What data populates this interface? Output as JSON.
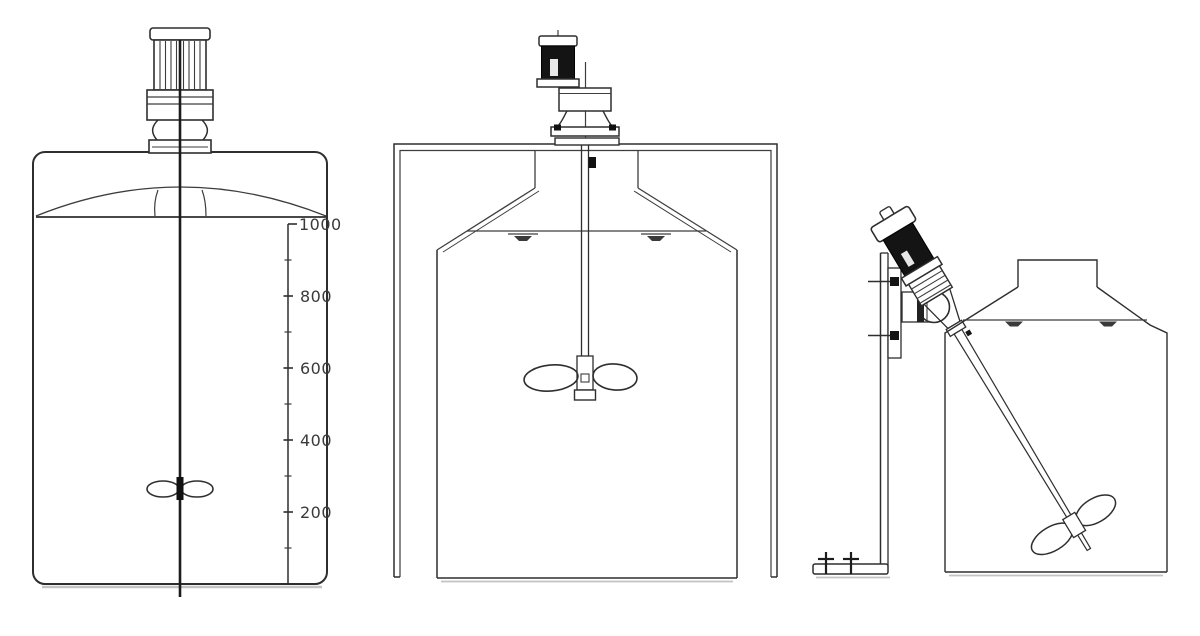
{
  "diagram": {
    "background": "#ffffff",
    "line_color": "#3d3d3d",
    "panels": [
      {
        "name": "top-entry-mixer-on-dished-head-tank-with-scale"
      },
      {
        "name": "frame-mounted-mixer-on-hopper-tank"
      },
      {
        "name": "angled-side-mounted-mixer-on-stand-with-hopper-tank"
      }
    ],
    "scale": {
      "ticks": [
        {
          "label": "1000"
        },
        {
          "label": "800"
        },
        {
          "label": "600"
        },
        {
          "label": "400"
        },
        {
          "label": "200"
        }
      ]
    }
  }
}
